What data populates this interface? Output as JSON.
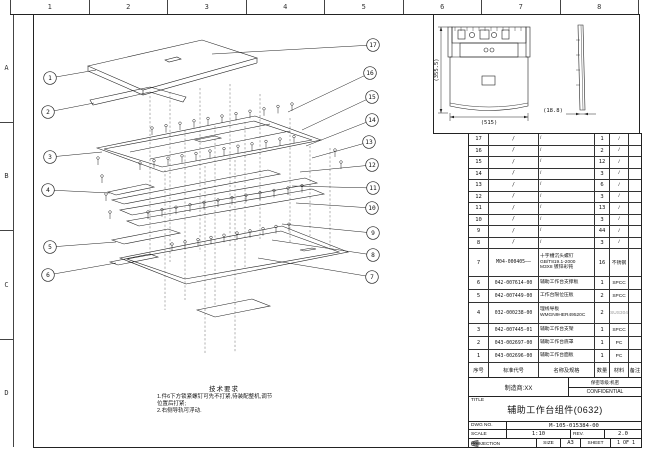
{
  "sheet": {
    "ruler_cols": [
      "1",
      "2",
      "3",
      "4",
      "5",
      "6",
      "7",
      "8"
    ],
    "ruler_rows": [
      "A",
      "B",
      "C",
      "D"
    ]
  },
  "views": {
    "dim_height": "(355.5)",
    "dim_width": "(515)",
    "dim_depth": "(18.8)"
  },
  "notes": {
    "title": "技术要求",
    "lines": [
      "1.件6下方锁紧螺钉可先不打紧,待装配整机,调节",
      "位置后打紧;",
      "2.右侧导轨可浮动."
    ]
  },
  "callouts": [
    {
      "label": "1",
      "x": 50,
      "y": 78,
      "tx": 96,
      "ty": 70
    },
    {
      "label": "2",
      "x": 48,
      "y": 112,
      "tx": 94,
      "ty": 103
    },
    {
      "label": "3",
      "x": 50,
      "y": 157,
      "tx": 102,
      "ty": 152
    },
    {
      "label": "4",
      "x": 48,
      "y": 190,
      "tx": 110,
      "ty": 193
    },
    {
      "label": "5",
      "x": 50,
      "y": 247,
      "tx": 116,
      "ty": 242
    },
    {
      "label": "6",
      "x": 48,
      "y": 275,
      "tx": 116,
      "ty": 263
    },
    {
      "label": "17",
      "x": 373,
      "y": 45,
      "tx": 212,
      "ty": 54
    },
    {
      "label": "16",
      "x": 370,
      "y": 73,
      "tx": 288,
      "ty": 112
    },
    {
      "label": "15",
      "x": 372,
      "y": 97,
      "tx": 302,
      "ty": 130
    },
    {
      "label": "14",
      "x": 372,
      "y": 120,
      "tx": 306,
      "ty": 146
    },
    {
      "label": "13",
      "x": 369,
      "y": 142,
      "tx": 312,
      "ty": 158
    },
    {
      "label": "12",
      "x": 372,
      "y": 165,
      "tx": 300,
      "ty": 172
    },
    {
      "label": "11",
      "x": 373,
      "y": 188,
      "tx": 292,
      "ty": 186
    },
    {
      "label": "10",
      "x": 372,
      "y": 208,
      "tx": 296,
      "ty": 203
    },
    {
      "label": "9",
      "x": 373,
      "y": 233,
      "tx": 282,
      "ty": 224
    },
    {
      "label": "8",
      "x": 373,
      "y": 255,
      "tx": 272,
      "ty": 240
    },
    {
      "label": "7",
      "x": 372,
      "y": 277,
      "tx": 258,
      "ty": 258
    }
  ],
  "parts_table": {
    "headers": [
      "序号",
      "标准代号",
      "名称及规格",
      "数量",
      "材料",
      "备注"
    ],
    "rows": [
      {
        "no": "17",
        "code": "/",
        "desc": "/",
        "qty": "1",
        "mat": "/",
        "remark": ""
      },
      {
        "no": "16",
        "code": "/",
        "desc": "/",
        "qty": "2",
        "mat": "/",
        "remark": ""
      },
      {
        "no": "15",
        "code": "/",
        "desc": "/",
        "qty": "12",
        "mat": "/",
        "remark": ""
      },
      {
        "no": "14",
        "code": "/",
        "desc": "/",
        "qty": "3",
        "mat": "/",
        "remark": ""
      },
      {
        "no": "13",
        "code": "/",
        "desc": "/",
        "qty": "6",
        "mat": "/",
        "remark": ""
      },
      {
        "no": "12",
        "code": "/",
        "desc": "/",
        "qty": "3",
        "mat": "/",
        "remark": ""
      },
      {
        "no": "11",
        "code": "/",
        "desc": "/",
        "qty": "13",
        "mat": "/",
        "remark": ""
      },
      {
        "no": "10",
        "code": "/",
        "desc": "/",
        "qty": "3",
        "mat": "/",
        "remark": ""
      },
      {
        "no": "9",
        "code": "/",
        "desc": "/",
        "qty": "44",
        "mat": "/",
        "remark": ""
      },
      {
        "no": "8",
        "code": "/",
        "desc": "/",
        "qty": "3",
        "mat": "/",
        "remark": ""
      },
      {
        "no": "7",
        "code": "M04-000405——",
        "desc": "十字槽沉头螺钉\nGB/T819.1-2000\nM3X8 镀锌彩钝",
        "qty": "16",
        "mat": "不锈钢",
        "remark": ""
      },
      {
        "no": "6",
        "code": "042-007614-00",
        "desc": "辅助工作台支撑板",
        "qty": "1",
        "mat": "SPCC",
        "remark": ""
      },
      {
        "no": "5",
        "code": "042-007449-00",
        "desc": "工作台限位压板",
        "qty": "2",
        "mat": "SPCC",
        "remark": ""
      },
      {
        "no": "4",
        "code": "032-000238-00",
        "desc": "理线导板\nWMGN9HER49520C",
        "qty": "2",
        "mat": "SUS304",
        "mat_dim": true,
        "remark": ""
      },
      {
        "no": "3",
        "code": "042-007445-01",
        "desc": "辅助工作台支架",
        "qty": "1",
        "mat": "SPCC",
        "remark": ""
      },
      {
        "no": "2",
        "code": "043-002697-00",
        "desc": "辅助工作台底罩",
        "qty": "1",
        "mat": "PC",
        "remark": ""
      },
      {
        "no": "1",
        "code": "043-002696-00",
        "desc": "辅助工作台面板",
        "qty": "1",
        "mat": "PC",
        "remark": ""
      }
    ]
  },
  "title_block": {
    "manufacturer": "制造商:XX",
    "secrecy": "保密等级:机密",
    "confidential": "CONFIDENTIAL",
    "title_label": "TITLE",
    "title": "辅助工作台组件(0632)",
    "dwg_no_label": "DWG NO.",
    "dwg_no": "M-105-015384-00",
    "scale_label": "SCALE",
    "scale": "1:10",
    "rev_label": "REV.",
    "rev": "2.0",
    "projection_label": "PROJECTION",
    "size_label": "SIZE",
    "size": "A3",
    "sheet_label": "SHEET",
    "sheet": "1 OF 1"
  }
}
